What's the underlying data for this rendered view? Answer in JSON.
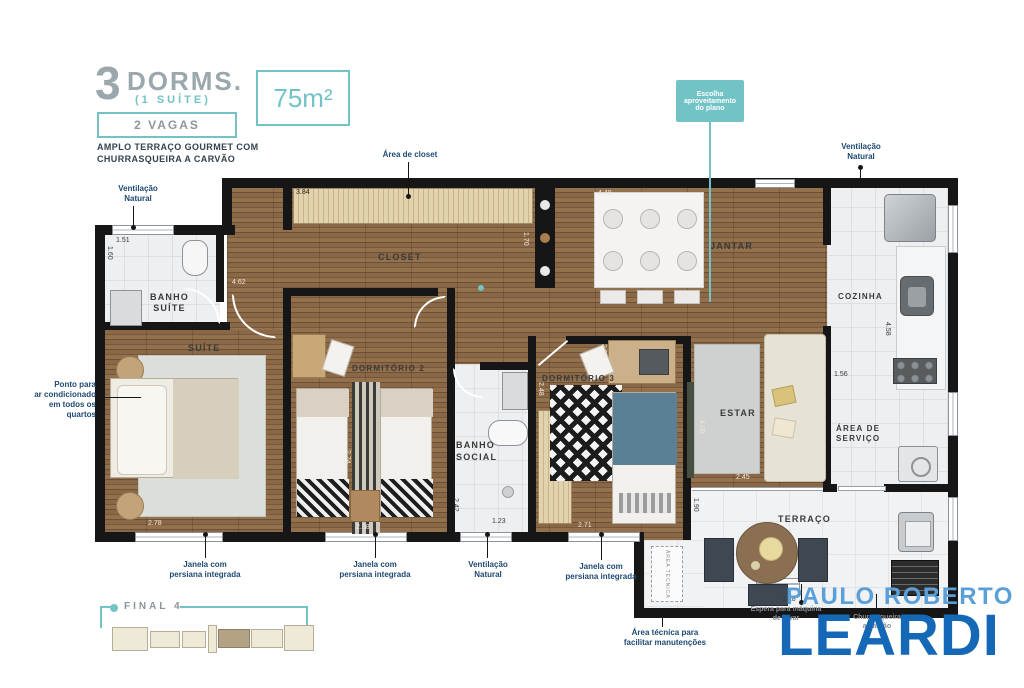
{
  "header": {
    "big_number": "3",
    "dorms": "DORMS.",
    "suite": "(1 SUÍTE)",
    "area": "75m²",
    "vagas": "2 VAGAS",
    "subtitle1": "AMPLO TERRAÇO GOURMET COM",
    "subtitle2": "CHURRASQUEIRA A CARVÃO"
  },
  "callout": {
    "l1": "Escolha",
    "l2": "aproveitamento",
    "l3": "do plano"
  },
  "rooms": {
    "banho_suite_l1": "BANHO",
    "banho_suite_l2": "SUÍTE",
    "suite": "SUÍTE",
    "closet": "CLOSET",
    "dorm2": "DORMITÓRIO 2",
    "banho_social_l1": "BANHO",
    "banho_social_l2": "SOCIAL",
    "dorm3": "DORMITÓRIO 3",
    "jantar": "JANTAR",
    "estar": "ESTAR",
    "cozinha": "COZINHA",
    "area_servico_l1": "ÁREA DE",
    "area_servico_l2": "SERVIÇO",
    "terraco": "TERRAÇO"
  },
  "annotations": {
    "ventilacao_l1": "Ventilação",
    "ventilacao_l2": "Natural",
    "area_closet": "Área de closet",
    "janela_l1": "Janela com",
    "janela_l2": "persiana integrada",
    "ponto_ar_l1": "Ponto para",
    "ponto_ar_l2": "ar condicionado",
    "ponto_ar_l3": "em todos os",
    "ponto_ar_l4": "quartos",
    "area_tecnica_l1": "Área técnica para",
    "area_tecnica_l2": "facilitar manutenções",
    "area_tecnica_inner": "ÁREA TÉCNICA",
    "maquina_l1": "Espera para máquina",
    "maquina_l2": "de lavar",
    "churrasqueira_l1": "Churrasqueira",
    "churrasqueira_l2": "a carvão"
  },
  "dims": {
    "banho_suite_w": "1.51",
    "banho_suite_h": "1.60",
    "closet_top": "3.84",
    "closet_w": "4.62",
    "closet_h": "1.70",
    "jantar_w": "4.48",
    "cozinha_w": "1.56",
    "cozinha_h": "4.58",
    "dorm2_h": "2.74",
    "dorm2_w": "2.38",
    "banho_social_h": "2.42",
    "banho_social_w": "1.23",
    "dorm3_top": "2.96",
    "dorm3_h": "2.48",
    "dorm3_w": "2.71",
    "suite_w": "2.78",
    "estar_h": "4.09",
    "estar_w": "2.45",
    "terraco_h": "1.90",
    "terraco_w": "3.18"
  },
  "keyplan": {
    "label": "FINAL 4"
  },
  "logo": {
    "line1": "PAULO ROBERTO",
    "line2": "LEARDI"
  },
  "colors": {
    "teal": "#72c3c5",
    "annotation_blue": "#1d4973",
    "logo_light_blue": "#5b9fd8",
    "logo_dark_blue": "#1568b6",
    "wall": "#161616"
  }
}
